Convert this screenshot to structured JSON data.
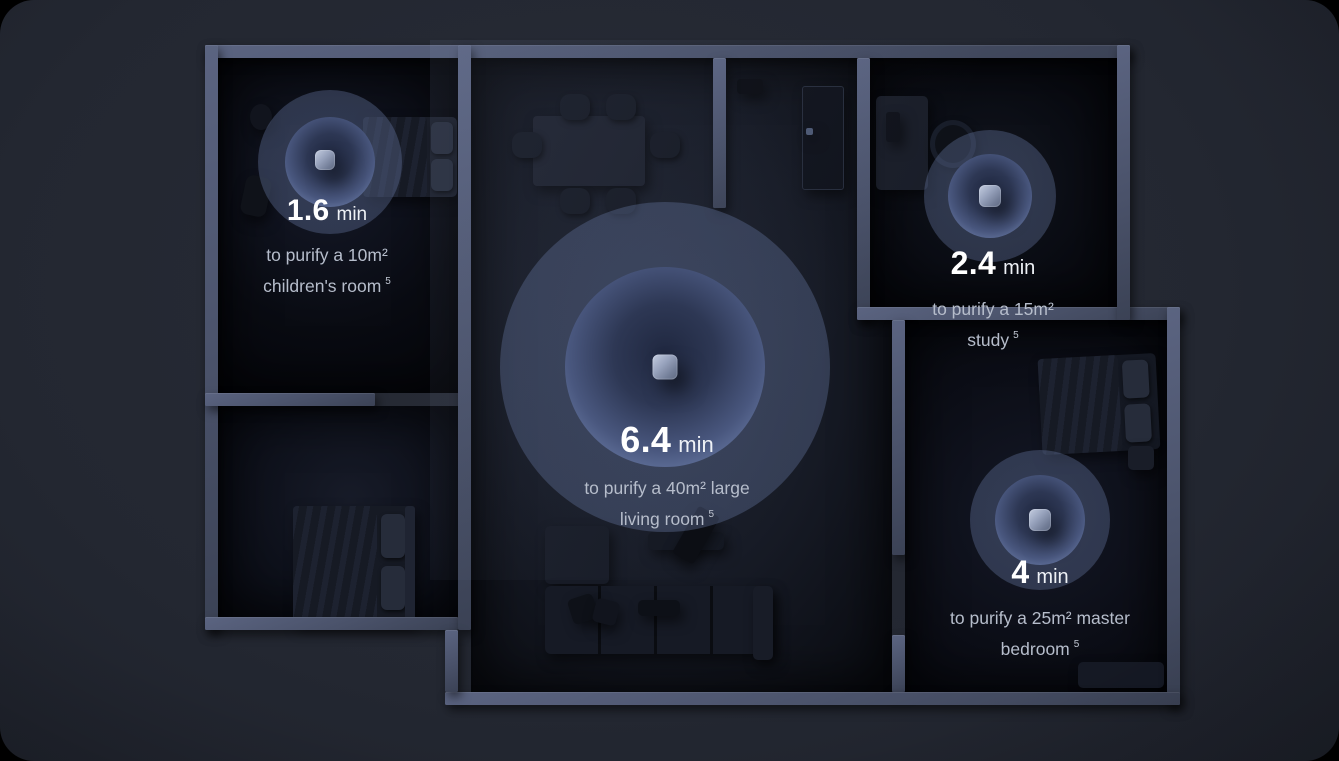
{
  "scene": {
    "colors": {
      "outer_background": "#000000",
      "card_background": "#232731",
      "wall": "#4e5874",
      "ripple_accent": "#7d8fba",
      "headline_text": "#ffffff",
      "description_text": "#b6bdcb"
    }
  },
  "rooms": {
    "children": {
      "time": "1.6",
      "unit": "min",
      "desc_line1": "to purify a 10m²",
      "desc_line2": "children's room",
      "footnote": "5"
    },
    "study": {
      "time": "2.4",
      "unit": "min",
      "desc_line1": "to purify a 15m²",
      "desc_line2": "study",
      "footnote": "5"
    },
    "living": {
      "time": "6.4",
      "unit": "min",
      "desc_line1": "to purify a 40m² large",
      "desc_line2": "living room",
      "footnote": "5"
    },
    "master": {
      "time": "4",
      "unit": "min",
      "desc_line1": "to purify a 25m² master",
      "desc_line2": "bedroom",
      "footnote": "5"
    }
  }
}
